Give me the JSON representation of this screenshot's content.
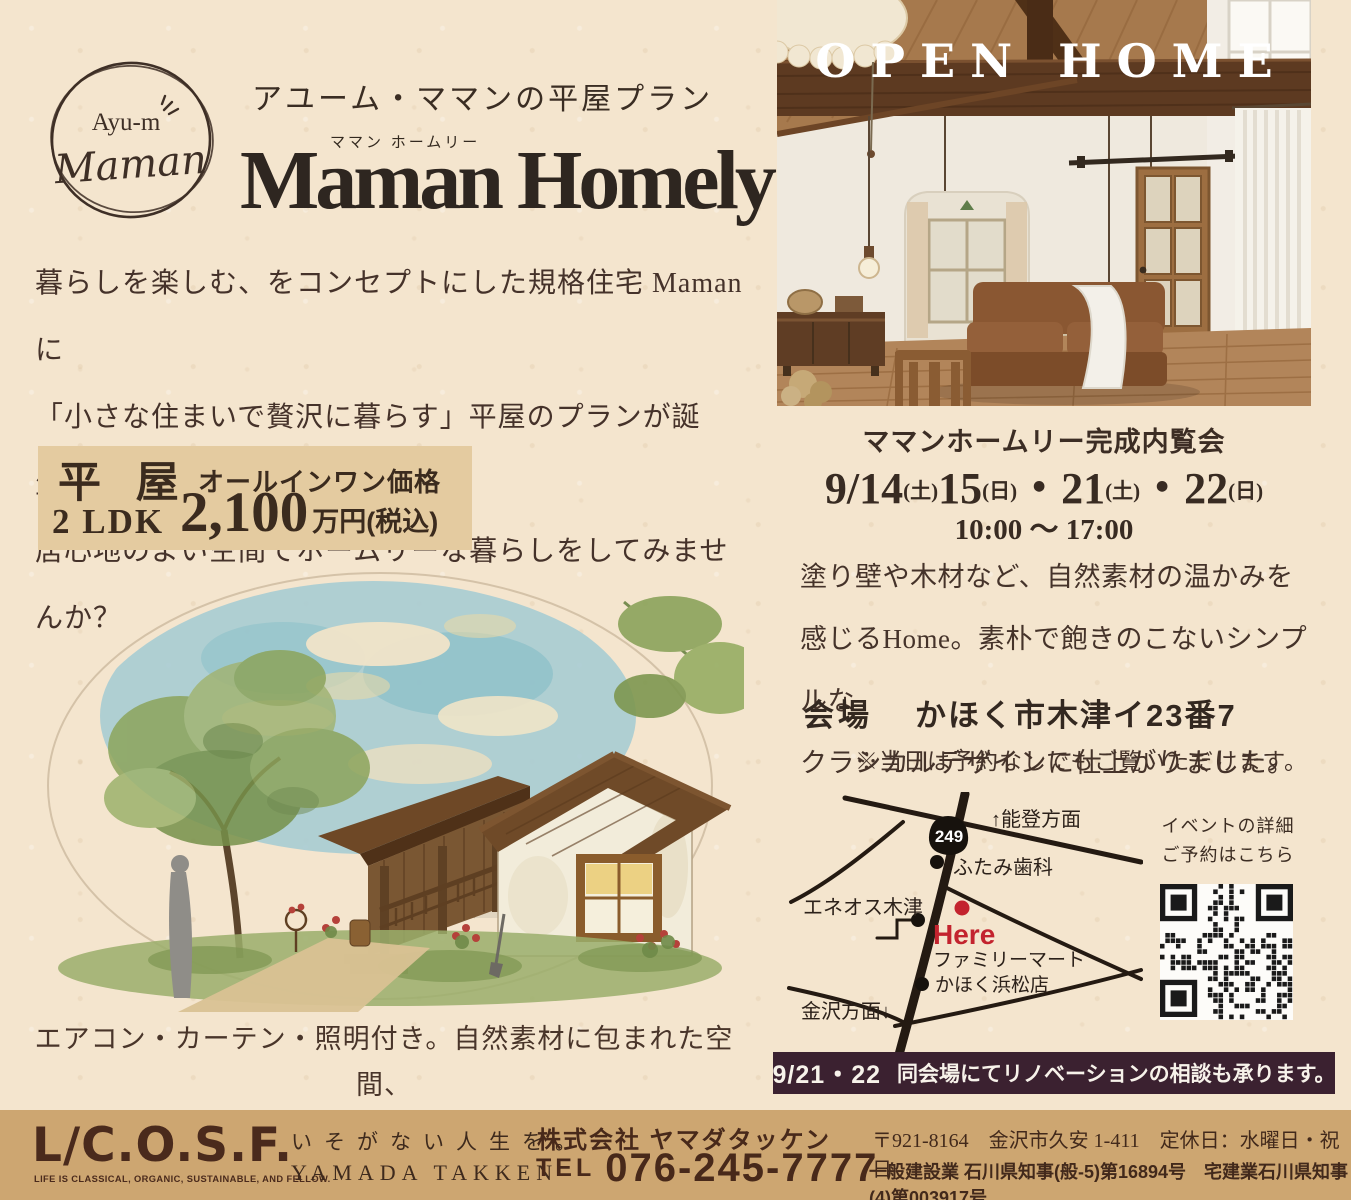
{
  "colors": {
    "paper": "#f4e5ce",
    "price_box_bg": "#e4cba0",
    "footer_band_bg": "#cda671",
    "dark_bar_bg": "#3b2130",
    "accent_red": "#c3232e",
    "ink": "#3a2c22",
    "beam_brown": "#5d3a21"
  },
  "brand": {
    "logo_line1": "Ayu-m",
    "logo_line2": "Maman",
    "series_title": "アユーム・ママンの平屋プラン",
    "product_furigana": "ママン ホームリー",
    "product_name": "Maman Homely"
  },
  "intro": {
    "line1": "暮らしを楽しむ、をコンセプトにした規格住宅 Maman に",
    "line2": "「小さな住まいで贅沢に暮らす」平屋のプランが誕生。",
    "line3": "居心地のよい空間でホームリーな暮らしをしてみませんか？"
  },
  "price_box": {
    "type_label": "平 屋",
    "price_label": "オールインワン価格",
    "plan_label": "2 LDK",
    "price_value": "2,100",
    "price_unit": "万円(税込)"
  },
  "illustration_caption": {
    "line1": "エアコン・カーテン・照明付き。自然素材に包まれた空間、",
    "line2": "寝室と水廻りをまとめた無駄がない動線が魅力の間取りです。"
  },
  "open_home": {
    "banner": "OPEN HOME",
    "event_title": "ママンホームリー完成内覧会",
    "dates": [
      {
        "num": "9/14",
        "day": "(土)"
      },
      {
        "num": "15",
        "day": "(日)"
      },
      {
        "num": "・21",
        "day": "(土)"
      },
      {
        "num": "・22",
        "day": "(日)"
      }
    ],
    "time": "10:00 〜 17:00",
    "desc_line1": "塗り壁や木材など、自然素材の温かみを",
    "desc_line2": "感じるHome。素朴で飽きのこないシンプルな",
    "desc_line3": "クラシカルデザインに仕上がりました。",
    "venue_label": "会場",
    "venue_value": "かほく市木津イ23番7",
    "note": "※当日は予約なしでもご覧いただけます。"
  },
  "map": {
    "north_label": "↑能登方面",
    "route_shield": "249",
    "dental_label": "ふたみ歯科",
    "eneos_label": "エネオス木津",
    "here_label": "Here",
    "famima_line1": "ファミリーマート",
    "famima_line2": "かほく浜松店",
    "south_label": "金沢方面↓"
  },
  "qr": {
    "caption_line1": "イベントの詳細",
    "caption_line2": "ご予約はこちら"
  },
  "renovation_bar": {
    "date": "9/21・22",
    "text": "同会場にてリノベーションの相談も承ります。"
  },
  "footer": {
    "logo": "L/C.O.S.F.",
    "logo_tagline": "LIFE IS CLASSICAL, ORGANIC, SUSTAINABLE, AND FELLOW.",
    "slogan_jp": "いそがない人生を。",
    "slogan_en": "YAMADA TAKKEN",
    "company": "株式会社 ヤマダタッケン",
    "tel_label": "TEL",
    "tel_number": "076-245-7777",
    "address": "〒921-8164　金沢市久安 1-411　定休日：水曜日・祝日",
    "license": "一般建設業 石川県知事(般-5)第16894号　宅建業石川県知事(4)第003917号"
  }
}
